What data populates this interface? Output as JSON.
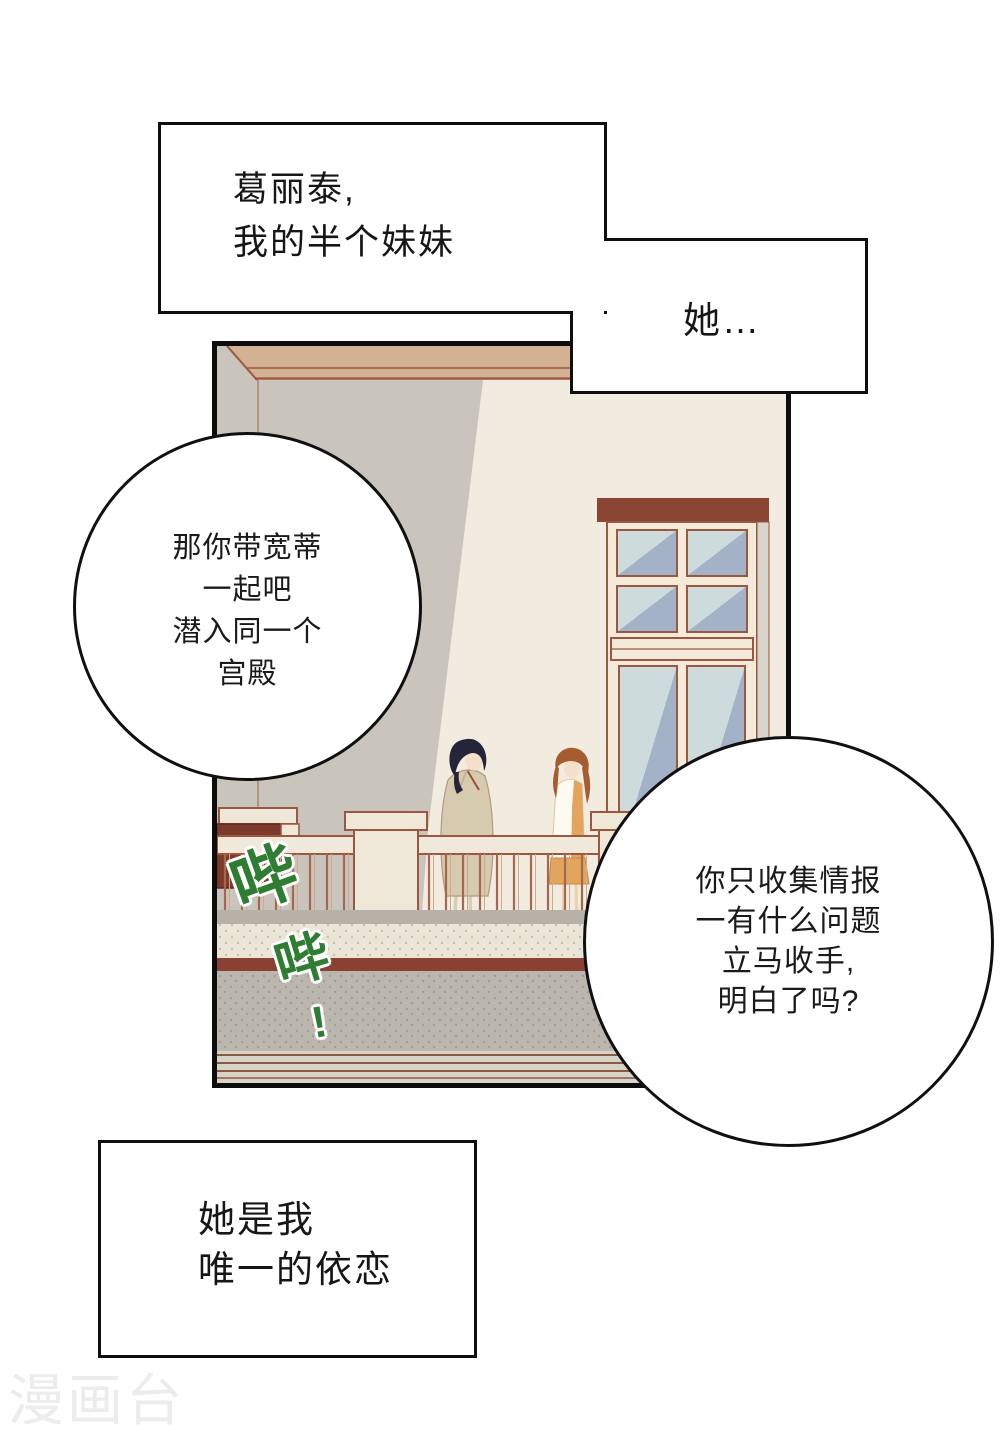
{
  "caption_top": {
    "lines": [
      "葛丽泰,",
      "我的半个妹妹"
    ]
  },
  "caption_she": {
    "text": "她…"
  },
  "bubble_left": {
    "lines": [
      "那你带宽蒂",
      "一起吧",
      "潜入同一个",
      "宫殿"
    ]
  },
  "bubble_right": {
    "lines": [
      "你只收集情报",
      "一有什么问题",
      "立马收手,",
      "明白了吗?"
    ]
  },
  "caption_bottom": {
    "lines": [
      "她是我",
      "唯一的依恋"
    ]
  },
  "sfx": {
    "chars": [
      "哔",
      "哔",
      "!"
    ],
    "color": "#2e7d32"
  },
  "watermark": {
    "text": "漫画台"
  },
  "palette": {
    "panel_wall": "#f1ebe0",
    "shadow_gray": "#c9c5bd",
    "beam_tan": "#d3b294",
    "outline_brown": "#9b5740",
    "planter_dark_red": "#7d3a2a",
    "floor_stripe_red": "#8a4133",
    "floor_gray": "#bbb7ae",
    "glass_light": "#cddbdc",
    "glass_dark": "#a3b2c6",
    "coat_tan": "#d6caaf",
    "dress_orange": "#e3a45b",
    "hair_dark": "#24243a",
    "hair_auburn": "#a55c2e",
    "skin": "#f4e0ca",
    "sfx_green": "#2e7d32",
    "watermark_gray": "#ececec"
  }
}
